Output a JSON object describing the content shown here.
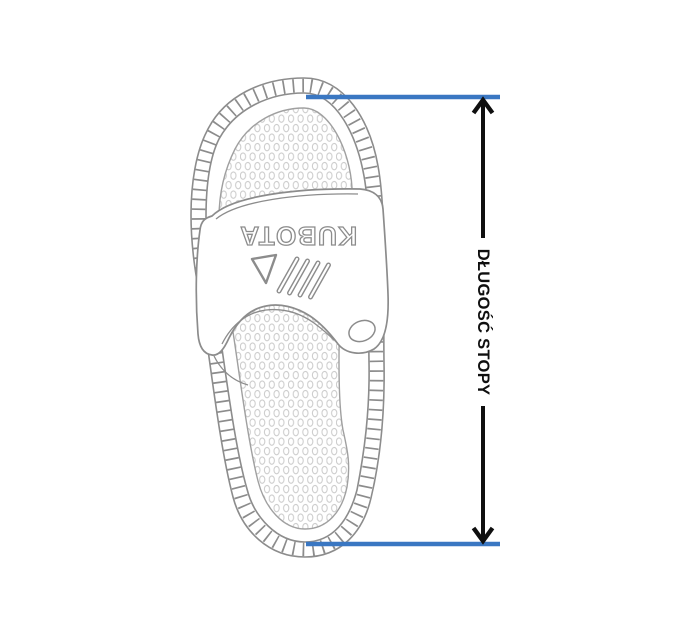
{
  "page": {
    "background": "#ffffff"
  },
  "sandal": {
    "brand": "KUBOTA"
  },
  "measurement": {
    "label": "DŁUGOŚĆ STOPY"
  },
  "colors": {
    "page-bg": "#ffffff",
    "paper": "#ffffff",
    "line-gray": "#8c8c8c",
    "line-light": "#a0a0a0",
    "dot-gray": "#cdcdcd",
    "measure-blue": "#3a77c2",
    "measure-black": "#0f0f0f"
  }
}
